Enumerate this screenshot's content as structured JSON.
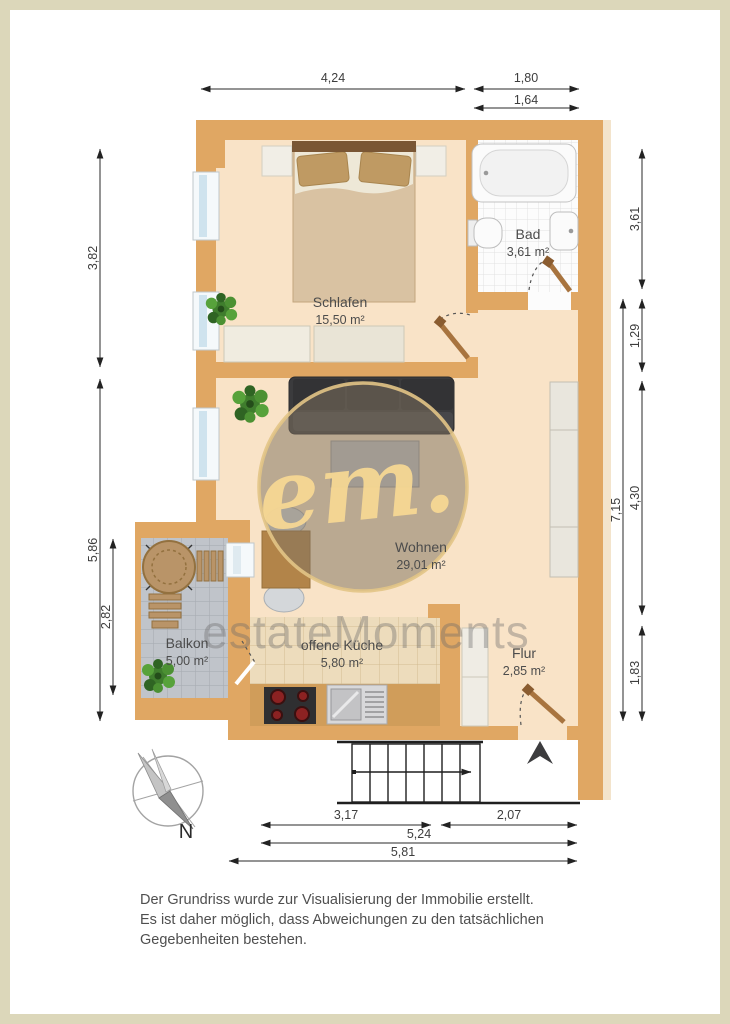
{
  "rooms": [
    {
      "name": "Schlafen",
      "area": "15,50 m²"
    },
    {
      "name": "Bad",
      "area": "3,61 m²"
    },
    {
      "name": "Wohnen",
      "area": "29,01 m²"
    },
    {
      "name": "Balkon",
      "area": "5,00 m²"
    },
    {
      "name": "offene Küche",
      "area": "5,80 m²"
    },
    {
      "name": "Flur",
      "area": "2,85 m²"
    }
  ],
  "dimensions": {
    "top": [
      "4,24",
      "1,80",
      "1,64"
    ],
    "left": [
      "3,82",
      "5,86",
      "2,82"
    ],
    "right": [
      "3,61",
      "1,29",
      "4,30",
      "1,83",
      "7,15"
    ],
    "bottom": [
      "3,17",
      "2,07",
      "5,24",
      "5,81"
    ]
  },
  "compass": {
    "label": "N"
  },
  "watermark": {
    "logo": "em.",
    "brand": "estateMoments"
  },
  "disclaimer": [
    "Der Grundriss wurde zur Visualisierung der Immobilie erstellt.",
    "Es ist daher möglich, dass Abweichungen zu den tatsächlichen",
    "Gegebenheiten bestehen."
  ],
  "colors": {
    "wall": "#e0a763",
    "floor": "#f9e3c7",
    "balcony_tile": "#c0c4ca",
    "kitchen_tile": "#eddcbc",
    "frame": "#dcd7ba"
  }
}
